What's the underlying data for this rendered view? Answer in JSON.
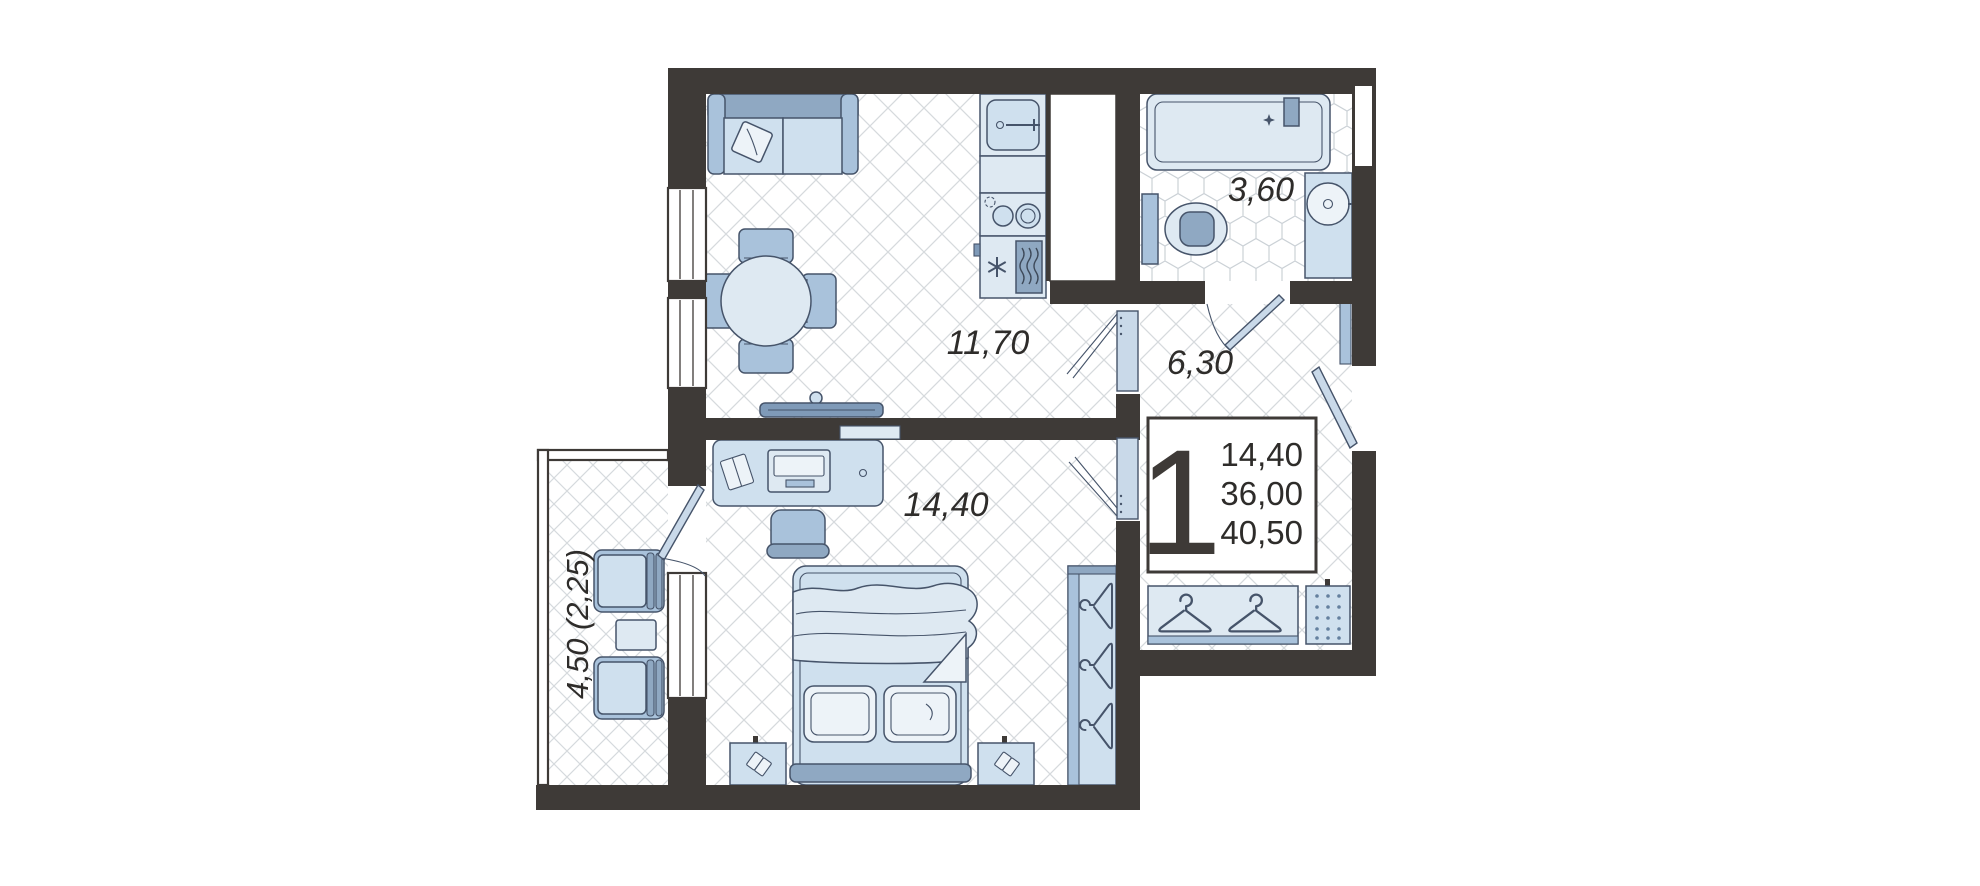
{
  "floorplan": {
    "labels": {
      "living_kitchen": "11,70",
      "hallway": "6,30",
      "bathroom": "3,60",
      "bedroom": "14,40",
      "balcony": "4,50 (2,25)"
    },
    "info_box": {
      "rooms_count": "1",
      "living_area": "14,40",
      "apartment_area": "36,00",
      "total_area": "40,50"
    },
    "colors": {
      "wall": "#3E3A37",
      "furniture_light": "#CFE0EE",
      "furniture_mid": "#A9C2DB",
      "furniture_dark": "#8FA8C2",
      "outline": "#46546A",
      "floor_line": "#D6DADD",
      "text": "#2E2C2A",
      "background": "#FFFFFF"
    }
  }
}
